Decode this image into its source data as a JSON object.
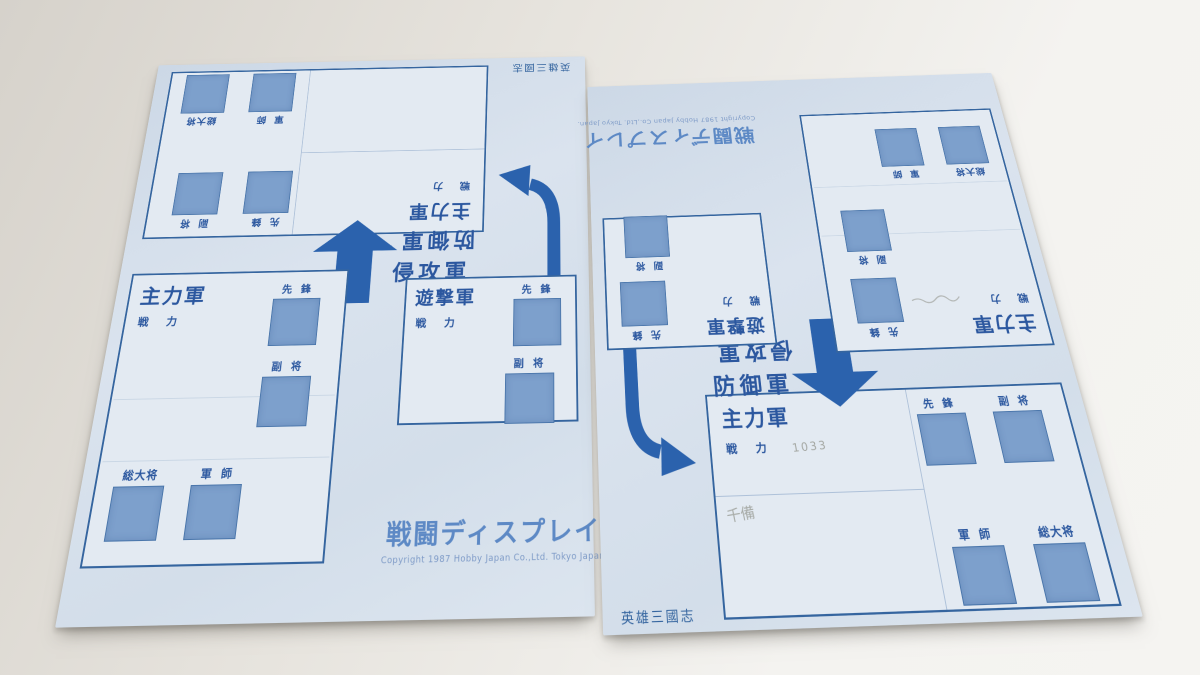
{
  "labels": {
    "main_army": "主力軍",
    "raiding_army": "遊撃軍",
    "invading_army": "侵攻軍",
    "defending_army": "防御軍",
    "strength": "戦 力",
    "vanguard": "先 鋒",
    "vice_general": "副 将",
    "strategist": "軍 師",
    "supreme_commander": "総大将"
  },
  "title_block": {
    "title": "戦闘ディスプレイ",
    "copyright": "Copyright 1987 Hobby Japan Co.,Ltd. Tokyo Japan."
  },
  "game_title": "英雄三國志",
  "handwriting": {
    "strength_value": "1033",
    "note": "千備"
  },
  "colors": {
    "sheet_b": "#dae3ee",
    "ink": "#2b579f",
    "square": "#7da0cc",
    "arrow": "#2b62ad",
    "brand": "#5d89c5",
    "pencil": "#94968e"
  }
}
